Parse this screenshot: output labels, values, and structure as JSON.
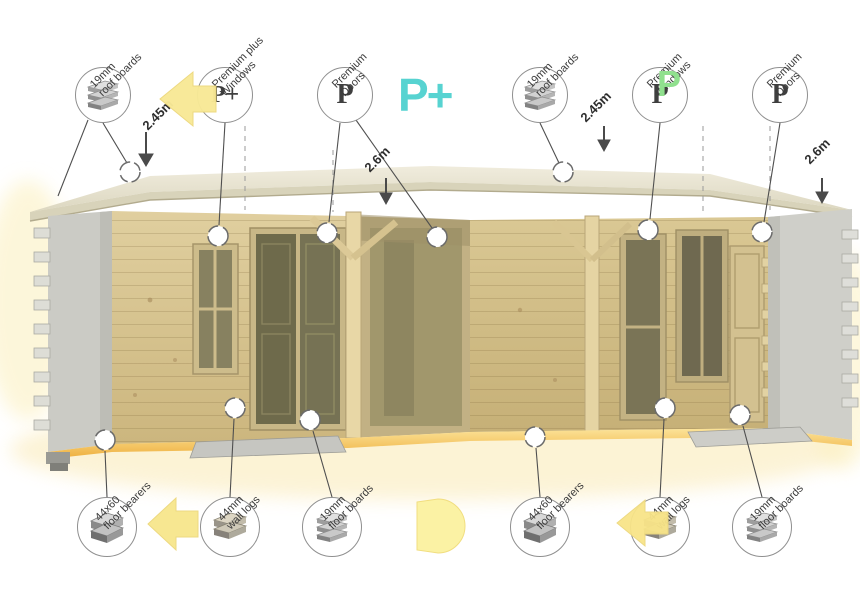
{
  "title": "Corner summerhouse feature infographic",
  "dimensions": {
    "d1": "2.45m",
    "d2": "2.6m",
    "d3": "2.45m",
    "d4": "2.6m"
  },
  "top_callouts": [
    {
      "id": "roof-boards-left",
      "icon": "planks",
      "letter": "",
      "label": "19mm\nroof boards"
    },
    {
      "id": "premium-plus-windows",
      "icon": "",
      "letter": "P+",
      "label": "Premium plus\nWindows"
    },
    {
      "id": "premium-doors-left",
      "icon": "",
      "letter": "P",
      "label": "Premium\nDoors"
    },
    {
      "id": "roof-boards-right",
      "icon": "planks",
      "letter": "",
      "label": "19mm\nroof boards"
    },
    {
      "id": "premium-windows-right",
      "icon": "",
      "letter": "P",
      "label": "Premium\nWindows"
    },
    {
      "id": "premium-doors-right",
      "icon": "",
      "letter": "P",
      "label": "Premium\nDoors"
    }
  ],
  "bottom_callouts": [
    {
      "id": "floor-bearers-left",
      "icon": "bearers",
      "label": "44x60\nfloor bearers"
    },
    {
      "id": "wall-logs-left",
      "icon": "logs",
      "label": "44mm\nwall logs"
    },
    {
      "id": "floor-boards-left",
      "icon": "planks",
      "label": "19mm\nfloor boards"
    },
    {
      "id": "floor-bearers-right",
      "icon": "bearers",
      "label": "44x60\nfloor bearers"
    },
    {
      "id": "wall-logs-right",
      "icon": "logs",
      "label": "44mm\nwall logs"
    },
    {
      "id": "floor-boards-right",
      "icon": "planks",
      "label": "19mm\nfloor boards"
    }
  ],
  "brand": {
    "premium_plus_mark": "P+",
    "premium_plus_color": "#57d3d1",
    "green_p_mark": "P",
    "green_p_color": "#90e08e"
  },
  "colors": {
    "roof": "#eae6d5",
    "pine_wall": "#dccb9b",
    "shadow_wall": "#cccccf",
    "dark_opening": "#6e6a4b",
    "base_orange": "#f2bd4e",
    "arrow_yellow": "#f8e996",
    "callout_line": "#4f4f4f",
    "text": "#3c3c3c"
  }
}
